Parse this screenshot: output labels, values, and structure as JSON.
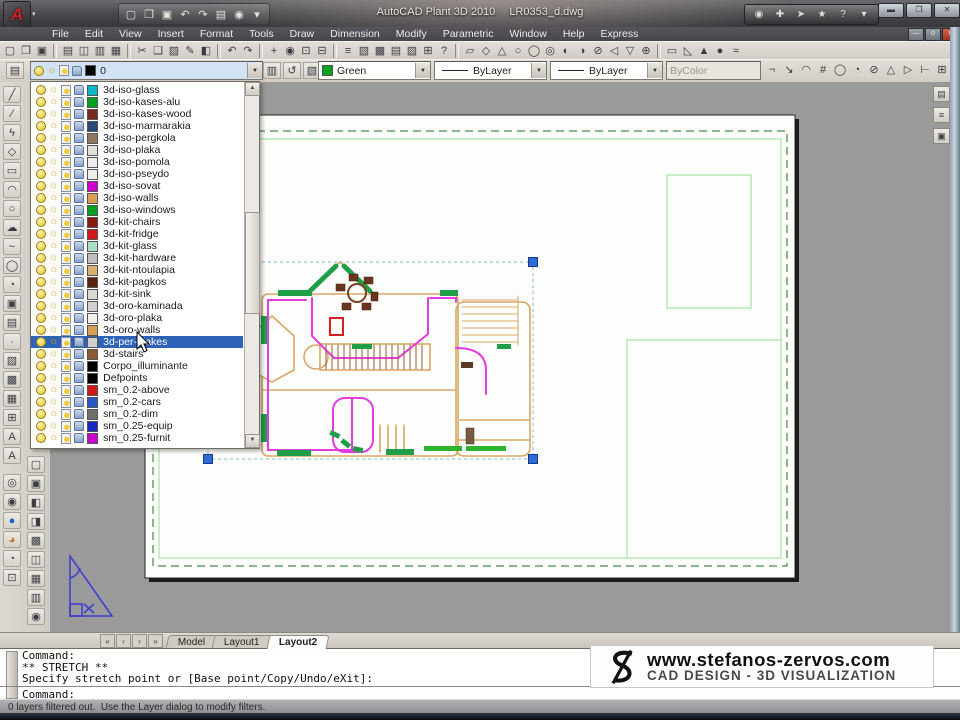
{
  "window": {
    "app_title": "AutoCAD Plant 3D 2010",
    "doc_title": "LR0353_d.dwg",
    "controls": {
      "minimize": "▬",
      "restore": "❐",
      "close": "✕"
    }
  },
  "menu_bar": {
    "items": [
      "File",
      "Edit",
      "View",
      "Insert",
      "Format",
      "Tools",
      "Draw",
      "Dimension",
      "Modify",
      "Parametric",
      "Window",
      "Help",
      "Express"
    ],
    "doc_controls": {
      "minimize": "—",
      "restore": "o",
      "close": "x"
    }
  },
  "quick_access": {
    "icons": [
      {
        "name": "qnew",
        "glyph": "▢"
      },
      {
        "name": "open",
        "glyph": "❐"
      },
      {
        "name": "save",
        "glyph": "▣"
      },
      {
        "name": "undo",
        "glyph": "↶"
      },
      {
        "name": "redo",
        "glyph": "↷",
        "disabled": true
      },
      {
        "name": "plot",
        "glyph": "▤"
      },
      {
        "name": "user",
        "glyph": "◉",
        "disabled": true
      },
      {
        "name": "customize-dropdown",
        "glyph": "▾"
      }
    ]
  },
  "infocenter": {
    "icons": [
      {
        "name": "search-binoculars",
        "glyph": "◉"
      },
      {
        "name": "subscription",
        "glyph": "✚"
      },
      {
        "name": "communication-center",
        "glyph": "➤"
      },
      {
        "name": "favorites",
        "glyph": "★"
      },
      {
        "name": "help",
        "glyph": "?"
      },
      {
        "name": "help-dropdown",
        "glyph": "▾"
      }
    ]
  },
  "toolbar_row1": {
    "icons": [
      {
        "name": "qnew",
        "glyph": "▢"
      },
      {
        "name": "open",
        "glyph": "❐"
      },
      {
        "name": "save",
        "glyph": "▣"
      },
      {
        "sep": true
      },
      {
        "name": "plot",
        "glyph": "▤"
      },
      {
        "name": "plot-preview",
        "glyph": "◫"
      },
      {
        "name": "publish",
        "glyph": "▥"
      },
      {
        "name": "export-dwf",
        "glyph": "▦"
      },
      {
        "sep": true
      },
      {
        "name": "cut",
        "glyph": "✂"
      },
      {
        "name": "copy",
        "glyph": "❏"
      },
      {
        "name": "paste",
        "glyph": "▨"
      },
      {
        "name": "match-properties",
        "glyph": "✎"
      },
      {
        "name": "block-editor",
        "glyph": "◧"
      },
      {
        "sep": true
      },
      {
        "name": "undo",
        "glyph": "↶"
      },
      {
        "name": "redo",
        "glyph": "↷"
      },
      {
        "sep": true
      },
      {
        "name": "pan",
        "glyph": "+"
      },
      {
        "name": "zoom-realtime",
        "glyph": "◉"
      },
      {
        "name": "zoom-window",
        "glyph": "⊡"
      },
      {
        "name": "zoom-previous",
        "glyph": "⊟"
      },
      {
        "sep": true
      },
      {
        "name": "properties",
        "glyph": "≡"
      },
      {
        "name": "designcenter",
        "glyph": "▧"
      },
      {
        "name": "tool-palettes",
        "glyph": "▩"
      },
      {
        "name": "sheet-set-manager",
        "glyph": "▤"
      },
      {
        "name": "markup-manager",
        "glyph": "▨"
      },
      {
        "name": "quickcalc",
        "glyph": "⊞"
      },
      {
        "name": "help",
        "glyph": "?"
      },
      {
        "sep": true
      },
      {
        "name": "project-manager",
        "glyph": "▱"
      },
      {
        "name": "equipment",
        "glyph": "◇"
      },
      {
        "name": "nozzle",
        "glyph": "△"
      },
      {
        "name": "route-pipe",
        "glyph": "○"
      },
      {
        "name": "pipe-spec",
        "glyph": "◯"
      },
      {
        "name": "valve",
        "glyph": "◎"
      },
      {
        "name": "fitting",
        "glyph": "◐"
      },
      {
        "name": "support",
        "glyph": "◑"
      },
      {
        "name": "slope-pipe",
        "glyph": "⊘"
      },
      {
        "name": "iso-view",
        "glyph": "◁"
      },
      {
        "name": "ortho-view",
        "glyph": "▽"
      },
      {
        "name": "render",
        "glyph": "⊕"
      },
      {
        "sep": true
      },
      {
        "name": "box-3d",
        "glyph": "▭"
      },
      {
        "name": "wedge-3d",
        "glyph": "◺"
      },
      {
        "name": "cone-3d",
        "glyph": "▲"
      },
      {
        "name": "sphere-3d",
        "glyph": "●"
      },
      {
        "name": "extrude",
        "glyph": "≈"
      }
    ]
  },
  "layers_toolbar": {
    "manager_icon": {
      "name": "layer-properties-manager",
      "glyph": "▤"
    },
    "combo_value": "0",
    "buttons": [
      {
        "name": "make-object-layer-current",
        "glyph": "▥"
      },
      {
        "name": "layer-previous",
        "glyph": "↺"
      },
      {
        "name": "layer-states-manager",
        "glyph": "▧"
      }
    ]
  },
  "properties_toolbar": {
    "color": {
      "label": "Green",
      "swatch": "#00a020"
    },
    "linetype": {
      "label": "ByLayer"
    },
    "lineweight": {
      "label": "ByLayer"
    },
    "plotstyle": {
      "label": "ByColor"
    },
    "right_icons": [
      {
        "name": "dim-linear",
        "glyph": "¬"
      },
      {
        "name": "dim-aligned",
        "glyph": "↘"
      },
      {
        "name": "dim-arc",
        "glyph": "◠"
      },
      {
        "name": "dim-ordinate",
        "glyph": "#"
      },
      {
        "name": "dim-radius",
        "glyph": "◯"
      },
      {
        "name": "dim-jogged",
        "glyph": "◔"
      },
      {
        "name": "dim-diameter",
        "glyph": "⊘"
      },
      {
        "name": "dim-angular",
        "glyph": "△"
      },
      {
        "name": "dim-continue",
        "glyph": "▷"
      },
      {
        "name": "dim-baseline",
        "glyph": "⊢"
      },
      {
        "name": "tolerance",
        "glyph": "⊞"
      },
      {
        "name": "center-mark",
        "glyph": "±"
      },
      {
        "name": "dim-angle",
        "glyph": "∠"
      }
    ]
  },
  "layer_dropdown": {
    "selected": "3d-per-plakes",
    "items": [
      {
        "name": "3d-iso-glass",
        "color": "#00b8c8"
      },
      {
        "name": "3d-iso-kases-alu",
        "color": "#00a020"
      },
      {
        "name": "3d-iso-kases-wood",
        "color": "#7a2820"
      },
      {
        "name": "3d-iso-marmarakia",
        "color": "#284878"
      },
      {
        "name": "3d-iso-pergkola",
        "color": "#907860"
      },
      {
        "name": "3d-iso-plaka",
        "color": "#e0e0e0"
      },
      {
        "name": "3d-iso-pomola",
        "color": "#ececec"
      },
      {
        "name": "3d-iso-pseydo",
        "color": "#ececec"
      },
      {
        "name": "3d-iso-sovat",
        "color": "#cc00cc"
      },
      {
        "name": "3d-iso-walls",
        "color": "#d8a050"
      },
      {
        "name": "3d-iso-windows",
        "color": "#00a020"
      },
      {
        "name": "3d-kit-chairs",
        "color": "#8a1a10"
      },
      {
        "name": "3d-kit-fridge",
        "color": "#d01818"
      },
      {
        "name": "3d-kit-glass",
        "color": "#a8e0c8"
      },
      {
        "name": "3d-kit-hardware",
        "color": "#c0c0c0"
      },
      {
        "name": "3d-kit-ntoulapia",
        "color": "#d8b070"
      },
      {
        "name": "3d-kit-pagkos",
        "color": "#5a2410"
      },
      {
        "name": "3d-kit-sink",
        "color": "#d8d8d8"
      },
      {
        "name": "3d-oro-kaminada",
        "color": "#d0d0d0"
      },
      {
        "name": "3d-oro-plaka",
        "color": "#f0f0f0"
      },
      {
        "name": "3d-oro-walls",
        "color": "#d8a050"
      },
      {
        "name": "3d-per-plakes",
        "color": "#d0d0d0"
      },
      {
        "name": "3d-stairs",
        "color": "#8a5a32"
      },
      {
        "name": "Corpo_illuminante",
        "color": "#000000"
      },
      {
        "name": "Defpoints",
        "color": "#000000"
      },
      {
        "name": "sm_0.2-above",
        "color": "#d01818"
      },
      {
        "name": "sm_0.2-cars",
        "color": "#2858c8"
      },
      {
        "name": "sm_0.2-dim",
        "color": "#707070"
      },
      {
        "name": "sm_0.25-equip",
        "color": "#1828c0"
      },
      {
        "name": "sm_0.25-furnit",
        "color": "#cc00cc"
      }
    ]
  },
  "draw_toolbar": {
    "icons": [
      {
        "name": "line",
        "glyph": "╱"
      },
      {
        "name": "construction-line",
        "glyph": "∕"
      },
      {
        "name": "polyline",
        "glyph": "ϟ"
      },
      {
        "name": "polygon",
        "glyph": "◇"
      },
      {
        "name": "rectangle",
        "glyph": "▭"
      },
      {
        "name": "arc",
        "glyph": "◠"
      },
      {
        "name": "circle",
        "glyph": "○"
      },
      {
        "name": "revision-cloud",
        "glyph": "☁"
      },
      {
        "name": "spline",
        "glyph": "~"
      },
      {
        "name": "ellipse",
        "glyph": "◯"
      },
      {
        "name": "ellipse-arc",
        "glyph": "◔"
      },
      {
        "name": "insert-block",
        "glyph": "▣"
      },
      {
        "name": "make-block",
        "glyph": "▤"
      },
      {
        "name": "point",
        "glyph": "·"
      },
      {
        "name": "hatch",
        "glyph": "▨"
      },
      {
        "name": "gradient",
        "glyph": "▩"
      },
      {
        "name": "region",
        "glyph": "▦"
      },
      {
        "name": "table",
        "glyph": "⊞"
      },
      {
        "name": "multiline-text",
        "glyph": "A"
      },
      {
        "name": "single-text",
        "glyph": "A"
      }
    ]
  },
  "orbit_toolbar": {
    "icons": [
      {
        "name": "constrained-orbit",
        "glyph": "◎"
      },
      {
        "name": "free-orbit",
        "glyph": "◉"
      },
      {
        "name": "sphere-shaded",
        "glyph": "●",
        "color": "#1f5fd0"
      },
      {
        "name": "sphere-render",
        "glyph": "◕",
        "color": "#c87818"
      },
      {
        "name": "continuous-orbit",
        "glyph": "◔"
      },
      {
        "name": "named-views",
        "glyph": "⊡"
      }
    ]
  },
  "visual_styles_toolbar": {
    "icons": [
      {
        "name": "2d-wireframe",
        "glyph": "▢"
      },
      {
        "name": "3d-wireframe",
        "glyph": "▣"
      },
      {
        "name": "3d-hidden",
        "glyph": "◧"
      },
      {
        "name": "realistic",
        "glyph": "◨"
      },
      {
        "name": "conceptual",
        "glyph": "▩"
      },
      {
        "name": "shades-of-gray",
        "glyph": "◫"
      },
      {
        "name": "sketchy",
        "glyph": "▦"
      },
      {
        "name": "render-preset",
        "glyph": "▥"
      },
      {
        "name": "zoom-object",
        "glyph": "◉"
      }
    ]
  },
  "mini_dock": {
    "icons": [
      {
        "name": "viewport-lock",
        "glyph": "▤"
      },
      {
        "name": "annotation-scale",
        "glyph": "≡"
      },
      {
        "name": "save-state",
        "glyph": "▣"
      }
    ]
  },
  "tabs": {
    "nav": [
      {
        "name": "first-tab",
        "glyph": "«"
      },
      {
        "name": "prev-tab",
        "glyph": "‹"
      },
      {
        "name": "next-tab",
        "glyph": "›"
      },
      {
        "name": "last-tab",
        "glyph": "»"
      }
    ],
    "items": [
      "Model",
      "Layout1",
      "Layout2"
    ],
    "active": "Layout2"
  },
  "command": {
    "lines": [
      "Command:",
      "** STRETCH **",
      "Specify stretch point or [Base point/Copy/Undo/eXit]:"
    ],
    "prompt": "Command:"
  },
  "status": "0 layers filtered out.  Use the Layer dialog to modify filters.",
  "watermark": {
    "url": "www.stefanos-zervos.com",
    "tagline": "CAD DESIGN - 3D VISUALIZATION"
  }
}
